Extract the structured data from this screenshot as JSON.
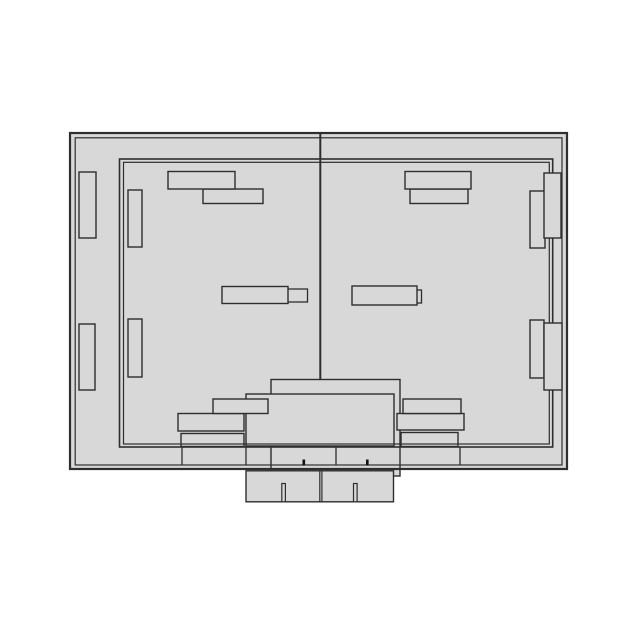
{
  "drawing": {
    "width": 640,
    "height": 640,
    "background": "#ffffff",
    "colors": {
      "fill": "#d8d8d8",
      "stroke": "#2e2e2e",
      "tick": "#111111"
    },
    "shapes": [
      {
        "name": "outer-shell",
        "type": "rect",
        "x": 70,
        "y": 133,
        "w": 497,
        "h": 336,
        "fill": "solid",
        "stroke": false
      },
      {
        "name": "rear-mount-block",
        "type": "rect",
        "x": 271,
        "y": 379.5,
        "w": 129,
        "h": 96.5,
        "fill": "solid",
        "sw": 1.4
      },
      {
        "name": "center-mount-block",
        "type": "rect",
        "x": 246,
        "y": 394,
        "w": 148,
        "h": 52,
        "fill": "solid",
        "sw": 1.4
      },
      {
        "name": "bracket-bottom-left-mid",
        "type": "rect",
        "x": 178,
        "y": 413.5,
        "w": 66,
        "h": 17.5,
        "fill": "solid",
        "sw": 1.4
      },
      {
        "name": "bracket-bottom-left-top",
        "type": "rect",
        "x": 213,
        "y": 399,
        "w": 55,
        "h": 14.5,
        "fill": "solid",
        "sw": 1.4
      },
      {
        "name": "bracket-bottom-left-base",
        "type": "rect",
        "x": 181,
        "y": 433.5,
        "w": 63,
        "h": 13,
        "fill": "solid",
        "sw": 1.4
      },
      {
        "name": "bracket-bottom-right-mid",
        "type": "rect",
        "x": 397,
        "y": 413.5,
        "w": 67,
        "h": 16.5,
        "fill": "solid",
        "sw": 1.4
      },
      {
        "name": "bracket-bottom-right-top",
        "type": "rect",
        "x": 403,
        "y": 399,
        "w": 58,
        "h": 14.5,
        "fill": "solid",
        "sw": 1.4
      },
      {
        "name": "bracket-bottom-right-base",
        "type": "rect",
        "x": 401,
        "y": 432.5,
        "w": 57,
        "h": 14,
        "fill": "solid",
        "sw": 1.4
      },
      {
        "name": "frame-outer-edge",
        "type": "rect",
        "x": 119.5,
        "y": 159,
        "w": 433.2,
        "h": 288,
        "fill": "none",
        "sw": 1.6
      },
      {
        "name": "frame-inner-edge",
        "type": "rect",
        "x": 123.5,
        "y": 162.3,
        "w": 425.8,
        "h": 281.7,
        "fill": "none",
        "sw": 1.2
      },
      {
        "name": "shell-outer-edge",
        "type": "rect",
        "x": 70,
        "y": 133,
        "w": 497,
        "h": 336,
        "fill": "none",
        "sw": 2.2
      },
      {
        "name": "shell-inner-edge",
        "type": "rect",
        "x": 75.2,
        "y": 137.8,
        "w": 486.8,
        "h": 327.2,
        "fill": "none",
        "sw": 1.2
      },
      {
        "name": "base-divider-1",
        "type": "line",
        "x1": 182,
        "y1": 447,
        "x2": 182,
        "y2": 465.3,
        "sw": 1.3
      },
      {
        "name": "base-divider-2",
        "type": "line",
        "x1": 246,
        "y1": 447,
        "x2": 246,
        "y2": 465.3,
        "sw": 1.3
      },
      {
        "name": "base-divider-3",
        "type": "line",
        "x1": 336,
        "y1": 447,
        "x2": 336,
        "y2": 465.3,
        "sw": 1.3
      },
      {
        "name": "base-divider-4",
        "type": "line",
        "x1": 460,
        "y1": 447,
        "x2": 460,
        "y2": 465.3,
        "sw": 1.3
      },
      {
        "name": "base-tick-left",
        "type": "rect",
        "x": 302.5,
        "y": 459.5,
        "w": 2.6,
        "h": 6,
        "fill": "dark",
        "stroke": false
      },
      {
        "name": "base-tick-right",
        "type": "rect",
        "x": 366,
        "y": 459.5,
        "w": 2.6,
        "h": 6,
        "fill": "dark",
        "stroke": false
      },
      {
        "name": "terminal-block",
        "type": "rect",
        "x": 246,
        "y": 470.8,
        "w": 147.5,
        "h": 31,
        "fill": "solid",
        "sw": 1.4
      },
      {
        "name": "terminal-divider-left",
        "type": "line",
        "x1": 319.8,
        "y1": 470.8,
        "x2": 319.8,
        "y2": 501.8,
        "sw": 1.2
      },
      {
        "name": "terminal-divider-right",
        "type": "line",
        "x1": 321.9,
        "y1": 470.8,
        "x2": 321.9,
        "y2": 501.8,
        "sw": 1.2
      },
      {
        "name": "terminal-slot-left",
        "type": "rect",
        "x": 281.8,
        "y": 483.5,
        "w": 3.6,
        "h": 18.3,
        "fill": "solid",
        "sw": 1.2
      },
      {
        "name": "terminal-slot-right",
        "type": "rect",
        "x": 353.5,
        "y": 483.5,
        "w": 3.6,
        "h": 18.3,
        "fill": "solid",
        "sw": 1.2
      },
      {
        "name": "hinge-door-left-top",
        "type": "rect",
        "x": 128,
        "y": 190,
        "w": 14,
        "h": 57,
        "fill": "solid",
        "sw": 1.4
      },
      {
        "name": "hinge-door-left-bottom",
        "type": "rect",
        "x": 128,
        "y": 319,
        "w": 14,
        "h": 58,
        "fill": "solid",
        "sw": 1.4
      },
      {
        "name": "hinge-shell-left-top",
        "type": "rect",
        "x": 79,
        "y": 172,
        "w": 17,
        "h": 66,
        "fill": "solid",
        "sw": 1.4
      },
      {
        "name": "hinge-shell-left-bottom",
        "type": "rect",
        "x": 79,
        "y": 324,
        "w": 16,
        "h": 66,
        "fill": "solid",
        "sw": 1.4
      },
      {
        "name": "hinge-door-right-top",
        "type": "rect",
        "x": 530,
        "y": 191,
        "w": 15,
        "h": 57,
        "fill": "solid",
        "sw": 1.4
      },
      {
        "name": "hinge-shell-right-top",
        "type": "rect",
        "x": 544,
        "y": 173,
        "w": 17,
        "h": 65,
        "fill": "solid",
        "sw": 1.4
      },
      {
        "name": "hinge-door-right-bottom",
        "type": "rect",
        "x": 530,
        "y": 320,
        "w": 14,
        "h": 58,
        "fill": "solid",
        "sw": 1.4
      },
      {
        "name": "hinge-shell-right-bottom",
        "type": "rect",
        "x": 544,
        "y": 323,
        "w": 18,
        "h": 67,
        "fill": "solid",
        "sw": 1.4
      },
      {
        "name": "bracket-top-left-lower",
        "type": "rect",
        "x": 203,
        "y": 189,
        "w": 60,
        "h": 14.5,
        "fill": "solid",
        "sw": 1.4
      },
      {
        "name": "bracket-top-left-upper",
        "type": "rect",
        "x": 168,
        "y": 171.5,
        "w": 67,
        "h": 17.5,
        "fill": "solid",
        "sw": 1.4
      },
      {
        "name": "bracket-top-right-lower",
        "type": "rect",
        "x": 410,
        "y": 189,
        "w": 58,
        "h": 14.5,
        "fill": "solid",
        "sw": 1.4
      },
      {
        "name": "bracket-top-right-upper",
        "type": "rect",
        "x": 405,
        "y": 171.5,
        "w": 66,
        "h": 17.5,
        "fill": "solid",
        "sw": 1.4
      },
      {
        "name": "handle-left-end",
        "type": "rect",
        "x": 286,
        "y": 289,
        "w": 21.5,
        "h": 13,
        "fill": "solid",
        "sw": 1.3
      },
      {
        "name": "handle-left",
        "type": "rect",
        "x": 222,
        "y": 286.5,
        "w": 66,
        "h": 17,
        "fill": "solid",
        "sw": 1.4
      },
      {
        "name": "handle-right-end",
        "type": "rect",
        "x": 416,
        "y": 290,
        "w": 5.5,
        "h": 13,
        "fill": "solid",
        "sw": 1.3
      },
      {
        "name": "handle-right",
        "type": "rect",
        "x": 352,
        "y": 286,
        "w": 65,
        "h": 19,
        "fill": "solid",
        "sw": 1.4
      },
      {
        "name": "door-divider",
        "type": "line",
        "x1": 320.3,
        "y1": 133,
        "x2": 320.3,
        "y2": 379.5,
        "sw": 2
      }
    ]
  }
}
